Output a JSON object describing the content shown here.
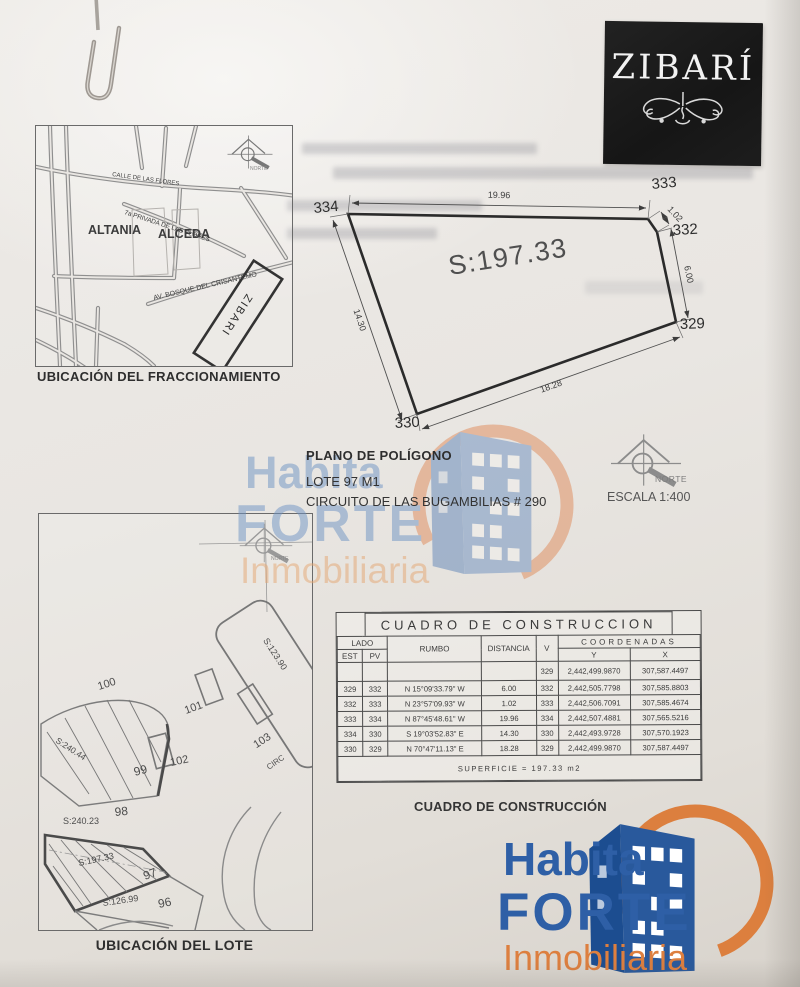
{
  "zibari": {
    "name": "ZIBARÍ"
  },
  "titles": {
    "plan_title": "PLANO DE POLÍGONO",
    "lot": "LOTE 97 M1",
    "address": "CIRCUITO DE LAS BUGAMBILIAS # 290",
    "scale": "ESCALA 1:400",
    "norte": "NORTE"
  },
  "fracc_map": {
    "caption": "UBICACIÓN DEL FRACCIONAMIENTO",
    "north": "NORTE",
    "area_altania": "ALTANIA",
    "area_alceda": "ALCEDA",
    "street_calle": "CALLE DE LAS FLORES",
    "street_privada": "7a PRIVADA DE LAS FLORES",
    "street_av": "AV. BOSQUE DEL CRISANTEMO",
    "parcel": "ZIBARI"
  },
  "polygon_plan": {
    "area_label": "S:197.33",
    "v334": "334",
    "v333": "333",
    "v332": "332",
    "v329": "329",
    "v330": "330",
    "dim_top": "19.96",
    "dim_corner": "1.02",
    "dim_right": "6.00",
    "dim_left": "14.30",
    "dim_bottom": "18.28"
  },
  "lot_map": {
    "caption": "UBICACIÓN DEL LOTE",
    "north": "NORTE",
    "street": "CIRC",
    "l100": "100",
    "l99": "99",
    "l102": "102",
    "l101": "101",
    "l103": "103",
    "l02": "02",
    "l98": "98",
    "l97": "97",
    "l96": "96",
    "s99": "S:240.44",
    "s02": "S:123.90",
    "s98": "S:240.23",
    "s97": "S:197.33",
    "s96": "S:126.99"
  },
  "table": {
    "title": "CUADRO DE CONSTRUCCION",
    "h_lado": "LADO",
    "h_est": "EST",
    "h_pv": "PV",
    "h_rumbo": "RUMBO",
    "h_distancia": "DISTANCIA",
    "h_v": "V",
    "h_coordenadas": "COORDENADAS",
    "h_y": "Y",
    "h_x": "X",
    "rows": [
      {
        "est": "",
        "pv": "",
        "rumbo": "",
        "dist": "",
        "v": "329",
        "y": "2,442,499.9870",
        "x": "307,587.4497"
      },
      {
        "est": "329",
        "pv": "332",
        "rumbo": "N 15°09'33.79\" W",
        "dist": "6.00",
        "v": "332",
        "y": "2,442,505.7798",
        "x": "307,585.8803"
      },
      {
        "est": "332",
        "pv": "333",
        "rumbo": "N 23°57'09.93\" W",
        "dist": "1.02",
        "v": "333",
        "y": "2,442,506.7091",
        "x": "307,585.4674"
      },
      {
        "est": "333",
        "pv": "334",
        "rumbo": "N 87°45'48.61\" W",
        "dist": "19.96",
        "v": "334",
        "y": "2,442,507.4881",
        "x": "307,565.5216"
      },
      {
        "est": "334",
        "pv": "330",
        "rumbo": "S 19°03'52.83\" E",
        "dist": "14.30",
        "v": "330",
        "y": "2,442,493.9728",
        "x": "307,570.1923"
      },
      {
        "est": "330",
        "pv": "329",
        "rumbo": "N 70°47'11.13\" E",
        "dist": "18.28",
        "v": "329",
        "y": "2,442,499.9870",
        "x": "307,587.4497"
      }
    ],
    "footer": "SUPERFICIE = 197.33 m2"
  },
  "construction_caption": "CUADRO DE CONSTRUCCIÓN",
  "logo": {
    "habita": "Habita",
    "forte": "FORTE",
    "inmobiliaria": "Inmobiliaria"
  },
  "colors": {
    "logo_blue": "#2e5fa6",
    "logo_orange": "#dd7f3f",
    "watermark_blue": "#6d93c4",
    "watermark_orange": "#e5a671"
  }
}
